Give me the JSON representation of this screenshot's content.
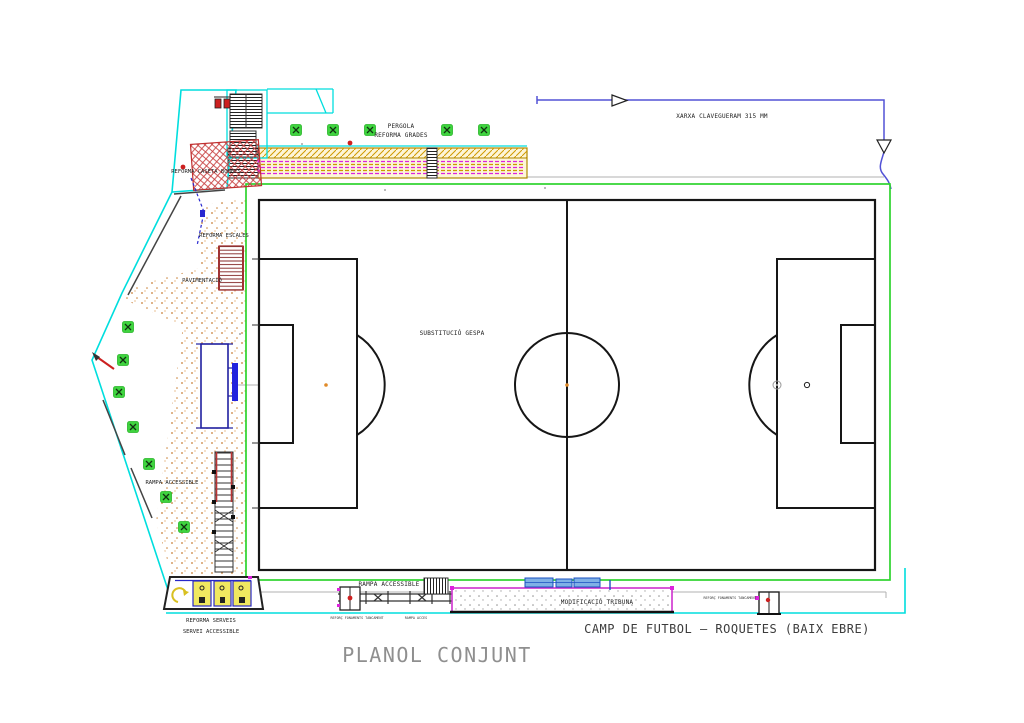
{
  "titles": {
    "sheet_title": "PLANOL CONJUNT",
    "project_title": "CAMP DE FUTBOL – ROQUETES (BAIX EBRE)"
  },
  "labels": {
    "pergola": "PERGOLA",
    "reforma_grades": "REFORMA GRADES",
    "xarxa_clavegueram": "XARXA CLAVEGUERAM 315 MM",
    "reforma_caseta_bombes": "REFORMA CASETA BOMBES",
    "reforma_escales": "REFORMA ESCALES",
    "pavimentacio": "PAVIMENTACIÓ",
    "substitucio_gespa": "SUBSTITUCIÓ GESPA",
    "rampa_accessible_left": "RAMPA ACCESSIBLE",
    "rampa_accessible_bottom": "RAMPA ACCESSIBLE",
    "modificacio_tribuna": "MODIFICACIÓ TRIBUNA",
    "reforma_serveis": "REFORMA SERVEIS",
    "servei_accessible": "SERVEI ACCESSIBLE",
    "reforc_fonaments_left": "REFORÇ FONAMENTS TANCAMENT",
    "rampa_acces": "RAMPA ACCES",
    "reforc_fonaments_right": "REFORÇ FONAMENTS TANCAMENT"
  },
  "colors": {
    "pitch_line": "#161616",
    "perimeter_green": "#2ed32e",
    "tree_green": "#3fd43f",
    "cyan_boundary": "#00dede",
    "magenta": "#dd22dd",
    "sewer_blue": "#5252d6",
    "hatch_red": "#c84040",
    "band_olive": "#b08800",
    "stipple_orange": "#c87f35",
    "navy": "#2020a0",
    "spot_orange": "#e08a28",
    "title_gray": "#8f8f8f"
  }
}
